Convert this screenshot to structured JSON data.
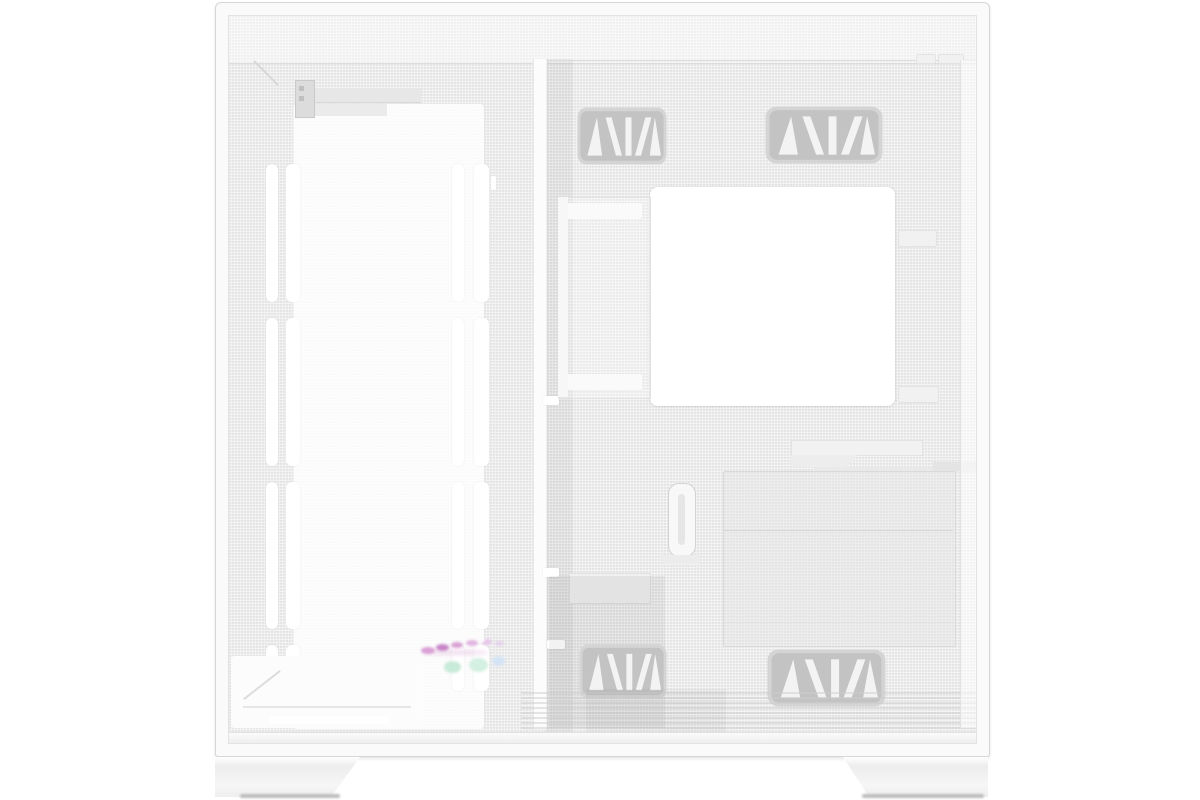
{
  "scene": {
    "type": "product-photo",
    "subject": "White mid-tower PC case, mesh side panel view showing interior chassis",
    "background": "#ffffff",
    "visible_text": ""
  },
  "palette": {
    "bg": "#ffffff",
    "case_face": "#f4f4f4",
    "mesh_dot": "#e2e2e2",
    "frame_line": "#d6d6d6",
    "panel_bright": "#fcfcfc",
    "line_soft": "#dcdcdc",
    "vent_rim": "#d4d4d4",
    "vent_dark": "#c3c3c3",
    "vent_white": "#f3f3f3",
    "foot_face": "#f3f3f3",
    "foot_shadow": "#bdbdbd",
    "rgb_pink": "#d9a0d5",
    "rgb_magenta": "#c887c8",
    "rgb_mint": "#c8ead8",
    "rgb_blue": "#d4e4f4"
  }
}
